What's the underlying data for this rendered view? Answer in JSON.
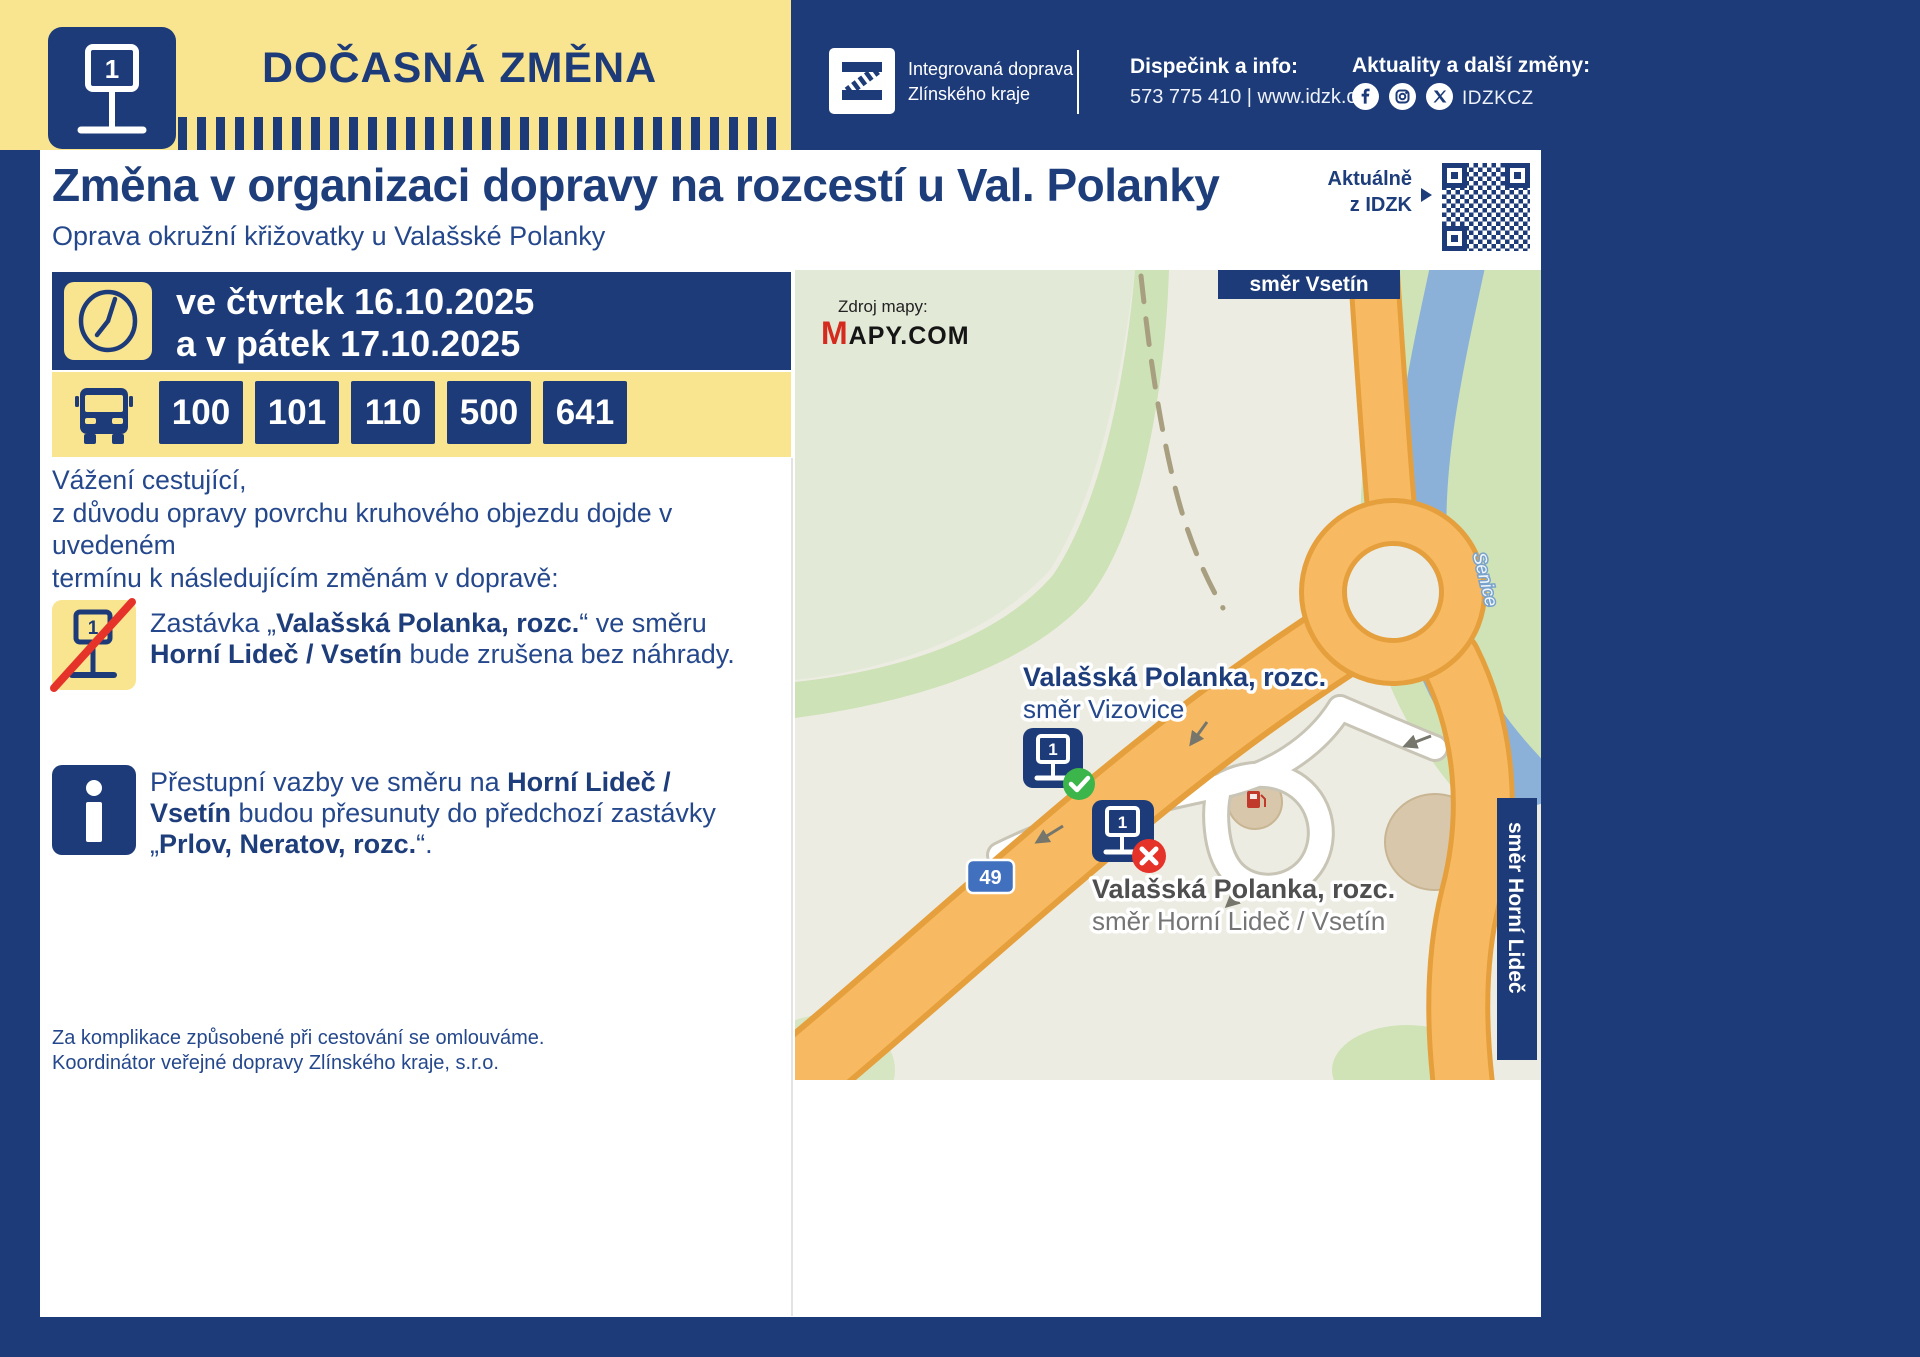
{
  "header": {
    "title": "DOČASNÁ ZMĚNA",
    "brand_line1": "Integrovaná doprava",
    "brand_line2": "Zlínského kraje",
    "dispatch_label": "Dispečink a info:",
    "dispatch_value": "573 775 410 | www.idzk.cz",
    "updates_label": "Aktuality a další změny:",
    "updates_handle": "IDZKCZ"
  },
  "title_block": {
    "heading": "Změna v organizaci dopravy na rozcestí u Val. Polanky",
    "subheading": "Oprava okružní křižovatky u Valašské Polanky",
    "qr_caption_line1": "Aktuálně",
    "qr_caption_line2": "z IDZK"
  },
  "schedule": {
    "line1": "ve čtvrtek 16.10.2025",
    "line2": "a v pátek 17.10.2025"
  },
  "lines": {
    "badges": [
      "100",
      "101",
      "110",
      "500",
      "641"
    ]
  },
  "notice": {
    "salutation": "Vážení cestující,",
    "intro_line1": "z důvodu opravy povrchu kruhového objezdu dojde v uvedeném",
    "intro_line2": "termínu k následujícím změnám v dopravě:",
    "cancelled_rich": [
      {
        "t": "Zastávka „",
        "b": false
      },
      {
        "t": "Valašská Polanka, rozc.",
        "b": true
      },
      {
        "t": "“ ve směru ",
        "b": false
      },
      {
        "t": "Horní Lideč / Vsetín",
        "b": true
      },
      {
        "t": " bude zrušena bez náhrady.",
        "b": false
      }
    ],
    "transfer_rich": [
      {
        "t": "Přestupní vazby ve směru na ",
        "b": false
      },
      {
        "t": "Horní Lideč / Vsetín",
        "b": true
      },
      {
        "t": " budou přesunuty do předchozí zastávky „",
        "b": false
      },
      {
        "t": "Prlov, Neratov, rozc.",
        "b": true
      },
      {
        "t": "“.",
        "b": false
      }
    ],
    "apology_line1": "Za komplikace způsobené při cestování se omlouváme.",
    "apology_line2": "Koordinátor veřejné dopravy Zlínského kraje, s.r.o."
  },
  "map": {
    "source_label": "Zdroj mapy:",
    "source_logo_m": "M",
    "source_logo_rest": "APY.COM",
    "direction_top": "směr Vsetín",
    "direction_right": "směr Horní Lideč",
    "river_name": "Senice",
    "road_number": "49",
    "stop_sign_digit": "1",
    "stop_active": {
      "name": "Valašská Polanka, rozc.",
      "direction": "směr Vizovice"
    },
    "stop_cancelled": {
      "name": "Valašská Polanka, rozc.",
      "direction": "směr Horní Lideč / Vsetín"
    }
  },
  "colors": {
    "navy": "#1d3b79",
    "yellow": "#f9e48f",
    "cancel_red": "#e6332a",
    "ok_green": "#3cb54a",
    "road_orange": "#f7ba62",
    "river_blue": "#8cb1d9"
  }
}
